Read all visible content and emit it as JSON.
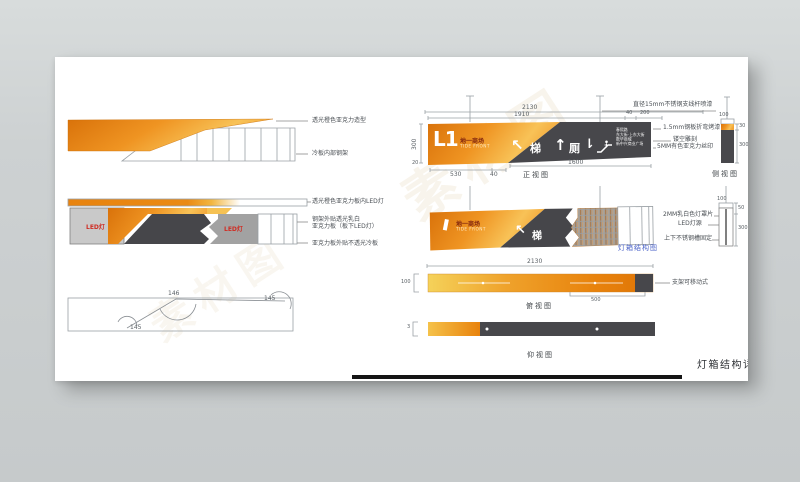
{
  "sheet": {
    "title": "灯箱结构详图"
  },
  "watermark": {
    "text": "素材图"
  },
  "left_panel": {
    "profile_top": {
      "callout_shape": "透光橙色亚克力造型",
      "callout_frame": "冷板内部钢架"
    },
    "profile_mid": {
      "led_left": "LED灯",
      "led_right": "LED灯",
      "callout_led": "透光橙色亚克力板内LED灯",
      "callout_white_1": "钢架外贴透光乳白",
      "callout_white_2": "亚克力板（板下LED灯）",
      "callout_cold": "亚克力板外贴不透光冷板"
    },
    "angle_view": {
      "angle_top": "146",
      "angle_left": "145",
      "angle_right": "145"
    }
  },
  "front_view": {
    "label": "正视图",
    "dims": {
      "total": "2130",
      "inner": "1910",
      "d40": "40",
      "d200": "200",
      "height": "300",
      "d20": "20",
      "d530": "530",
      "d40b": "40",
      "d1600": "1600"
    },
    "logo": {
      "main": "L1",
      "cn": "地一商场",
      "en": "TIDE FRONT"
    },
    "icons": {
      "arrow_upleft": "↖",
      "escalator_cn": "梯",
      "arrow_up": "↑",
      "toilet_cn": "厕",
      "arrow_down": "⇂"
    },
    "small_lines": [
      "春熙路",
      "东大街·上东大街",
      "数华商城",
      "新中兴商业广场"
    ],
    "callouts": {
      "rod": "直径15mm不锈钢支线杆喷漆",
      "steel": "1.5mm钢板折弯烤漆",
      "hollow": "镂空雕刻",
      "acrylic": "5MM有色亚克力丝印"
    }
  },
  "side_view": {
    "label": "侧视图",
    "dims": {
      "w100": "100",
      "d30": "30",
      "d300": "300"
    }
  },
  "structure_view": {
    "label": "灯箱结构图",
    "logo": {
      "cn": "地一商场",
      "en": "TIDE FRONT"
    },
    "icons": {
      "arrow_upleft": "↖",
      "escalator_cn": "梯"
    },
    "callouts": {
      "cover": "2MM乳白色灯罩片",
      "led": "LED灯源",
      "fix": "上下不锈钢槽固定"
    },
    "dims": {
      "w100": "100",
      "d50": "50",
      "d300": "300"
    }
  },
  "top_view": {
    "label": "俯视图",
    "dims": {
      "total": "2130",
      "h100": "100",
      "d500": "500"
    },
    "callout_bracket": "支架可移动式"
  },
  "bottom_view": {
    "label": "仰视图",
    "dims": {
      "d3": "3"
    }
  }
}
